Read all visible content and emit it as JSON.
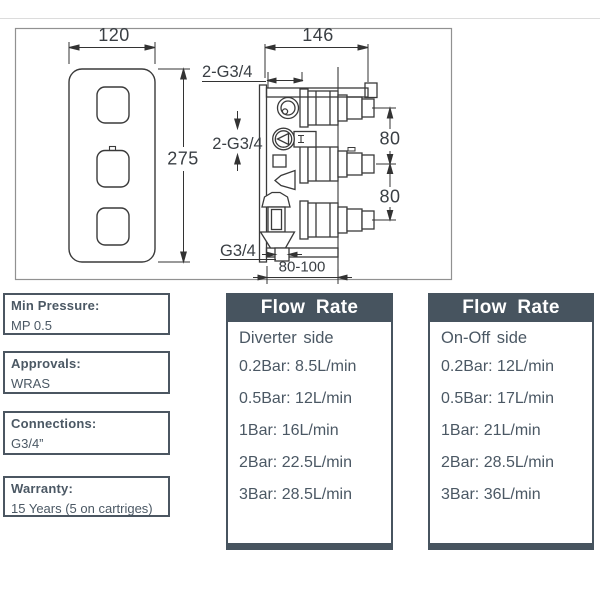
{
  "drawing": {
    "front_view": {
      "width": "120",
      "height": "275"
    },
    "side_view": {
      "width": "146",
      "top_connection": "2-G3/4",
      "inlet_connection": "2-G3/4",
      "outlet_connection": "G3/4",
      "port_spacing_upper": "80",
      "port_spacing_lower": "80",
      "depth_range": "80-100"
    }
  },
  "specs": [
    {
      "label": "Min Pressure:",
      "value": "MP 0.5"
    },
    {
      "label": "Approvals:",
      "value": "WRAS"
    },
    {
      "label": "Connections:",
      "value": "G3/4”"
    },
    {
      "label": "Warranty:",
      "value": "15 Years (5 on cartriges)"
    }
  ],
  "flow_tables": [
    {
      "title": "Flow Rate",
      "subtitle": "Diverter side",
      "rows": [
        {
          "pressure": "0.2Bar:",
          "flow": "8.5L/min"
        },
        {
          "pressure": "0.5Bar:",
          "flow": "12L/min"
        },
        {
          "pressure": "1Bar:",
          "flow": "16L/min"
        },
        {
          "pressure": "2Bar:",
          "flow": "22.5L/min"
        },
        {
          "pressure": "3Bar:",
          "flow": "28.5L/min"
        }
      ]
    },
    {
      "title": "Flow Rate",
      "subtitle": "On-Off side",
      "rows": [
        {
          "pressure": "0.2Bar:",
          "flow": "12L/min"
        },
        {
          "pressure": "0.5Bar:",
          "flow": "17L/min"
        },
        {
          "pressure": "1Bar:",
          "flow": "21L/min"
        },
        {
          "pressure": "2Bar:",
          "flow": "28.5L/min"
        },
        {
          "pressure": "3Bar:",
          "flow": "36L/min"
        }
      ]
    }
  ],
  "colors": {
    "accent": "#47545f",
    "text": "#4b5864",
    "line": "#3a3a3a"
  }
}
